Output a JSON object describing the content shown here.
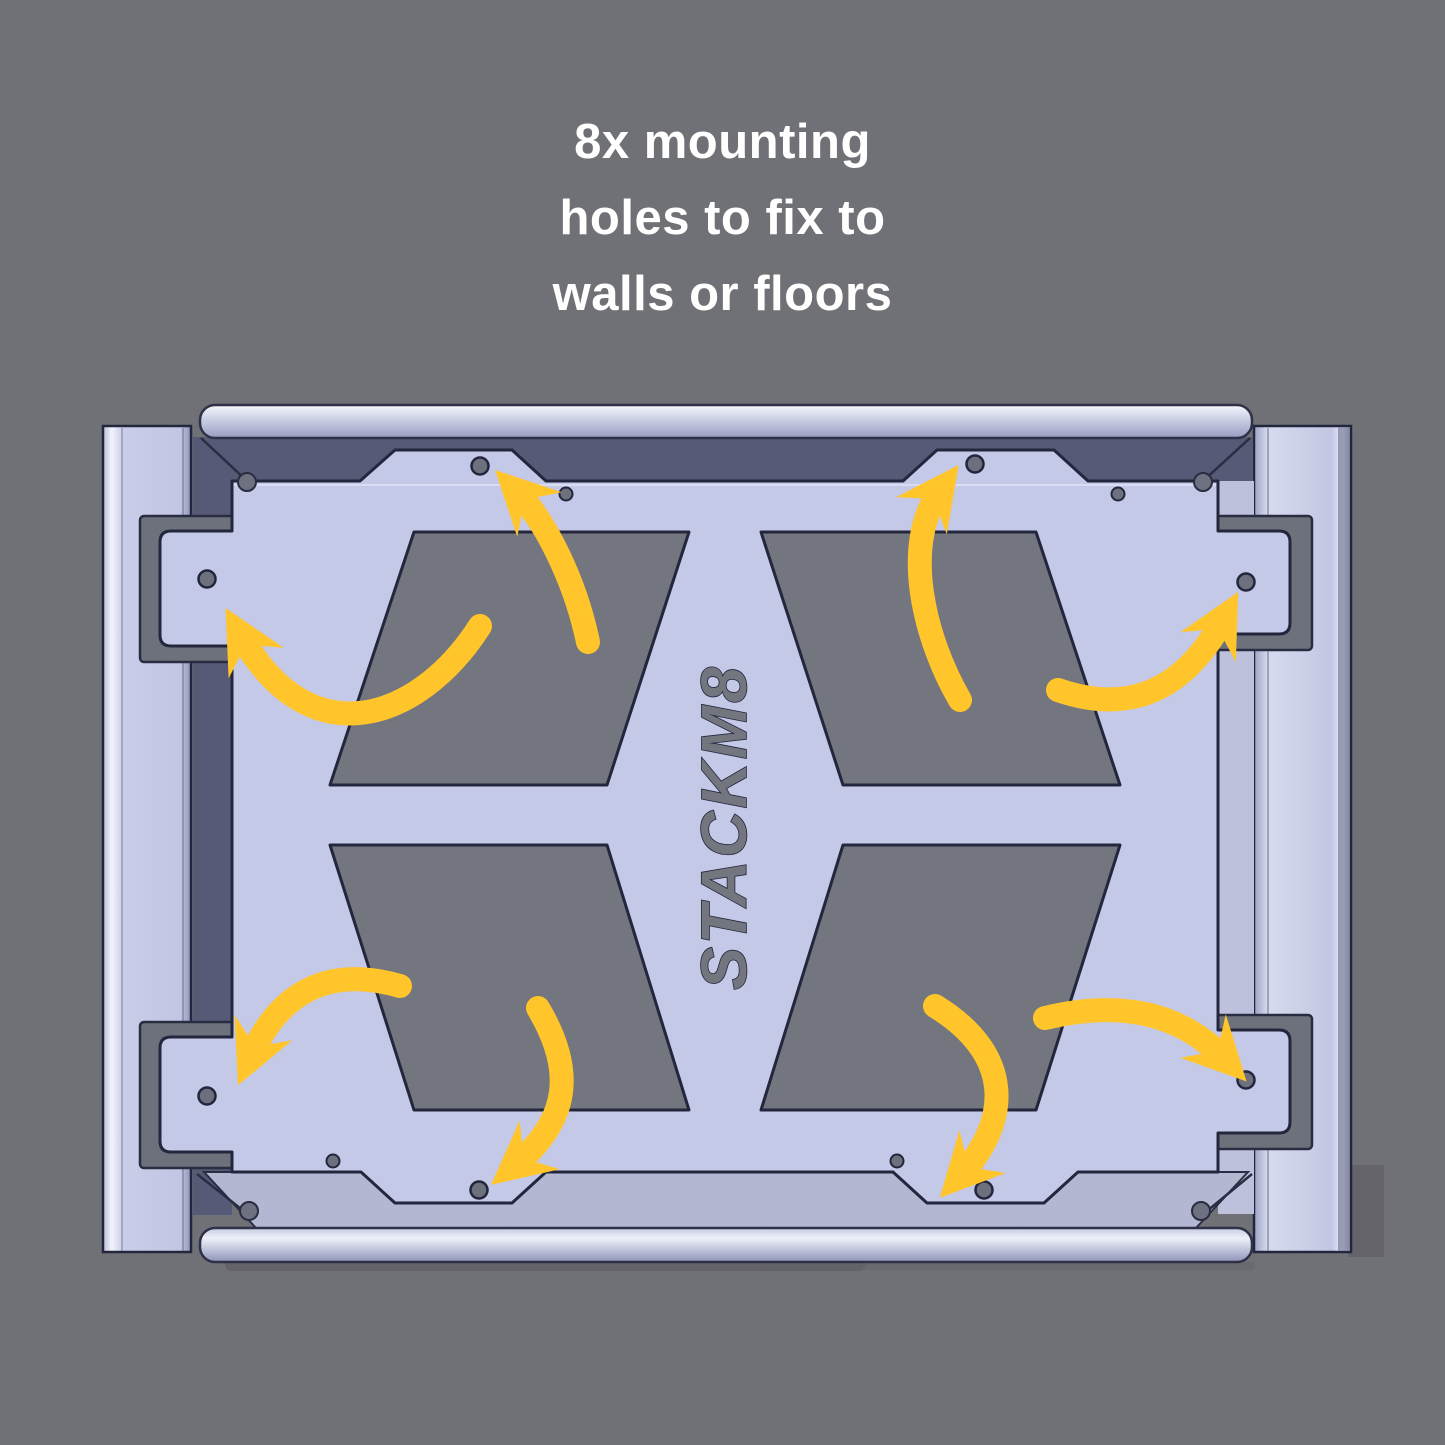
{
  "title": {
    "line1": "8x mounting",
    "line2": "holes to fix to",
    "line3": "walls or floors"
  },
  "assembly": {
    "logo_text": "STACKM8",
    "mounting_hole_count": 8,
    "arrow_count": 8
  },
  "colors": {
    "background": "#707176",
    "title_text": "#ffffff",
    "plate": "#c5c9e8",
    "shadow_band": "#565a76",
    "lit_band": "#b3b7d2",
    "side_band": "#bdc1dc",
    "cutout": "#73767e",
    "bracket": "#6d717b",
    "hole": "#6d717e",
    "outline": "#23263c",
    "arrow": "#ffc52b"
  }
}
